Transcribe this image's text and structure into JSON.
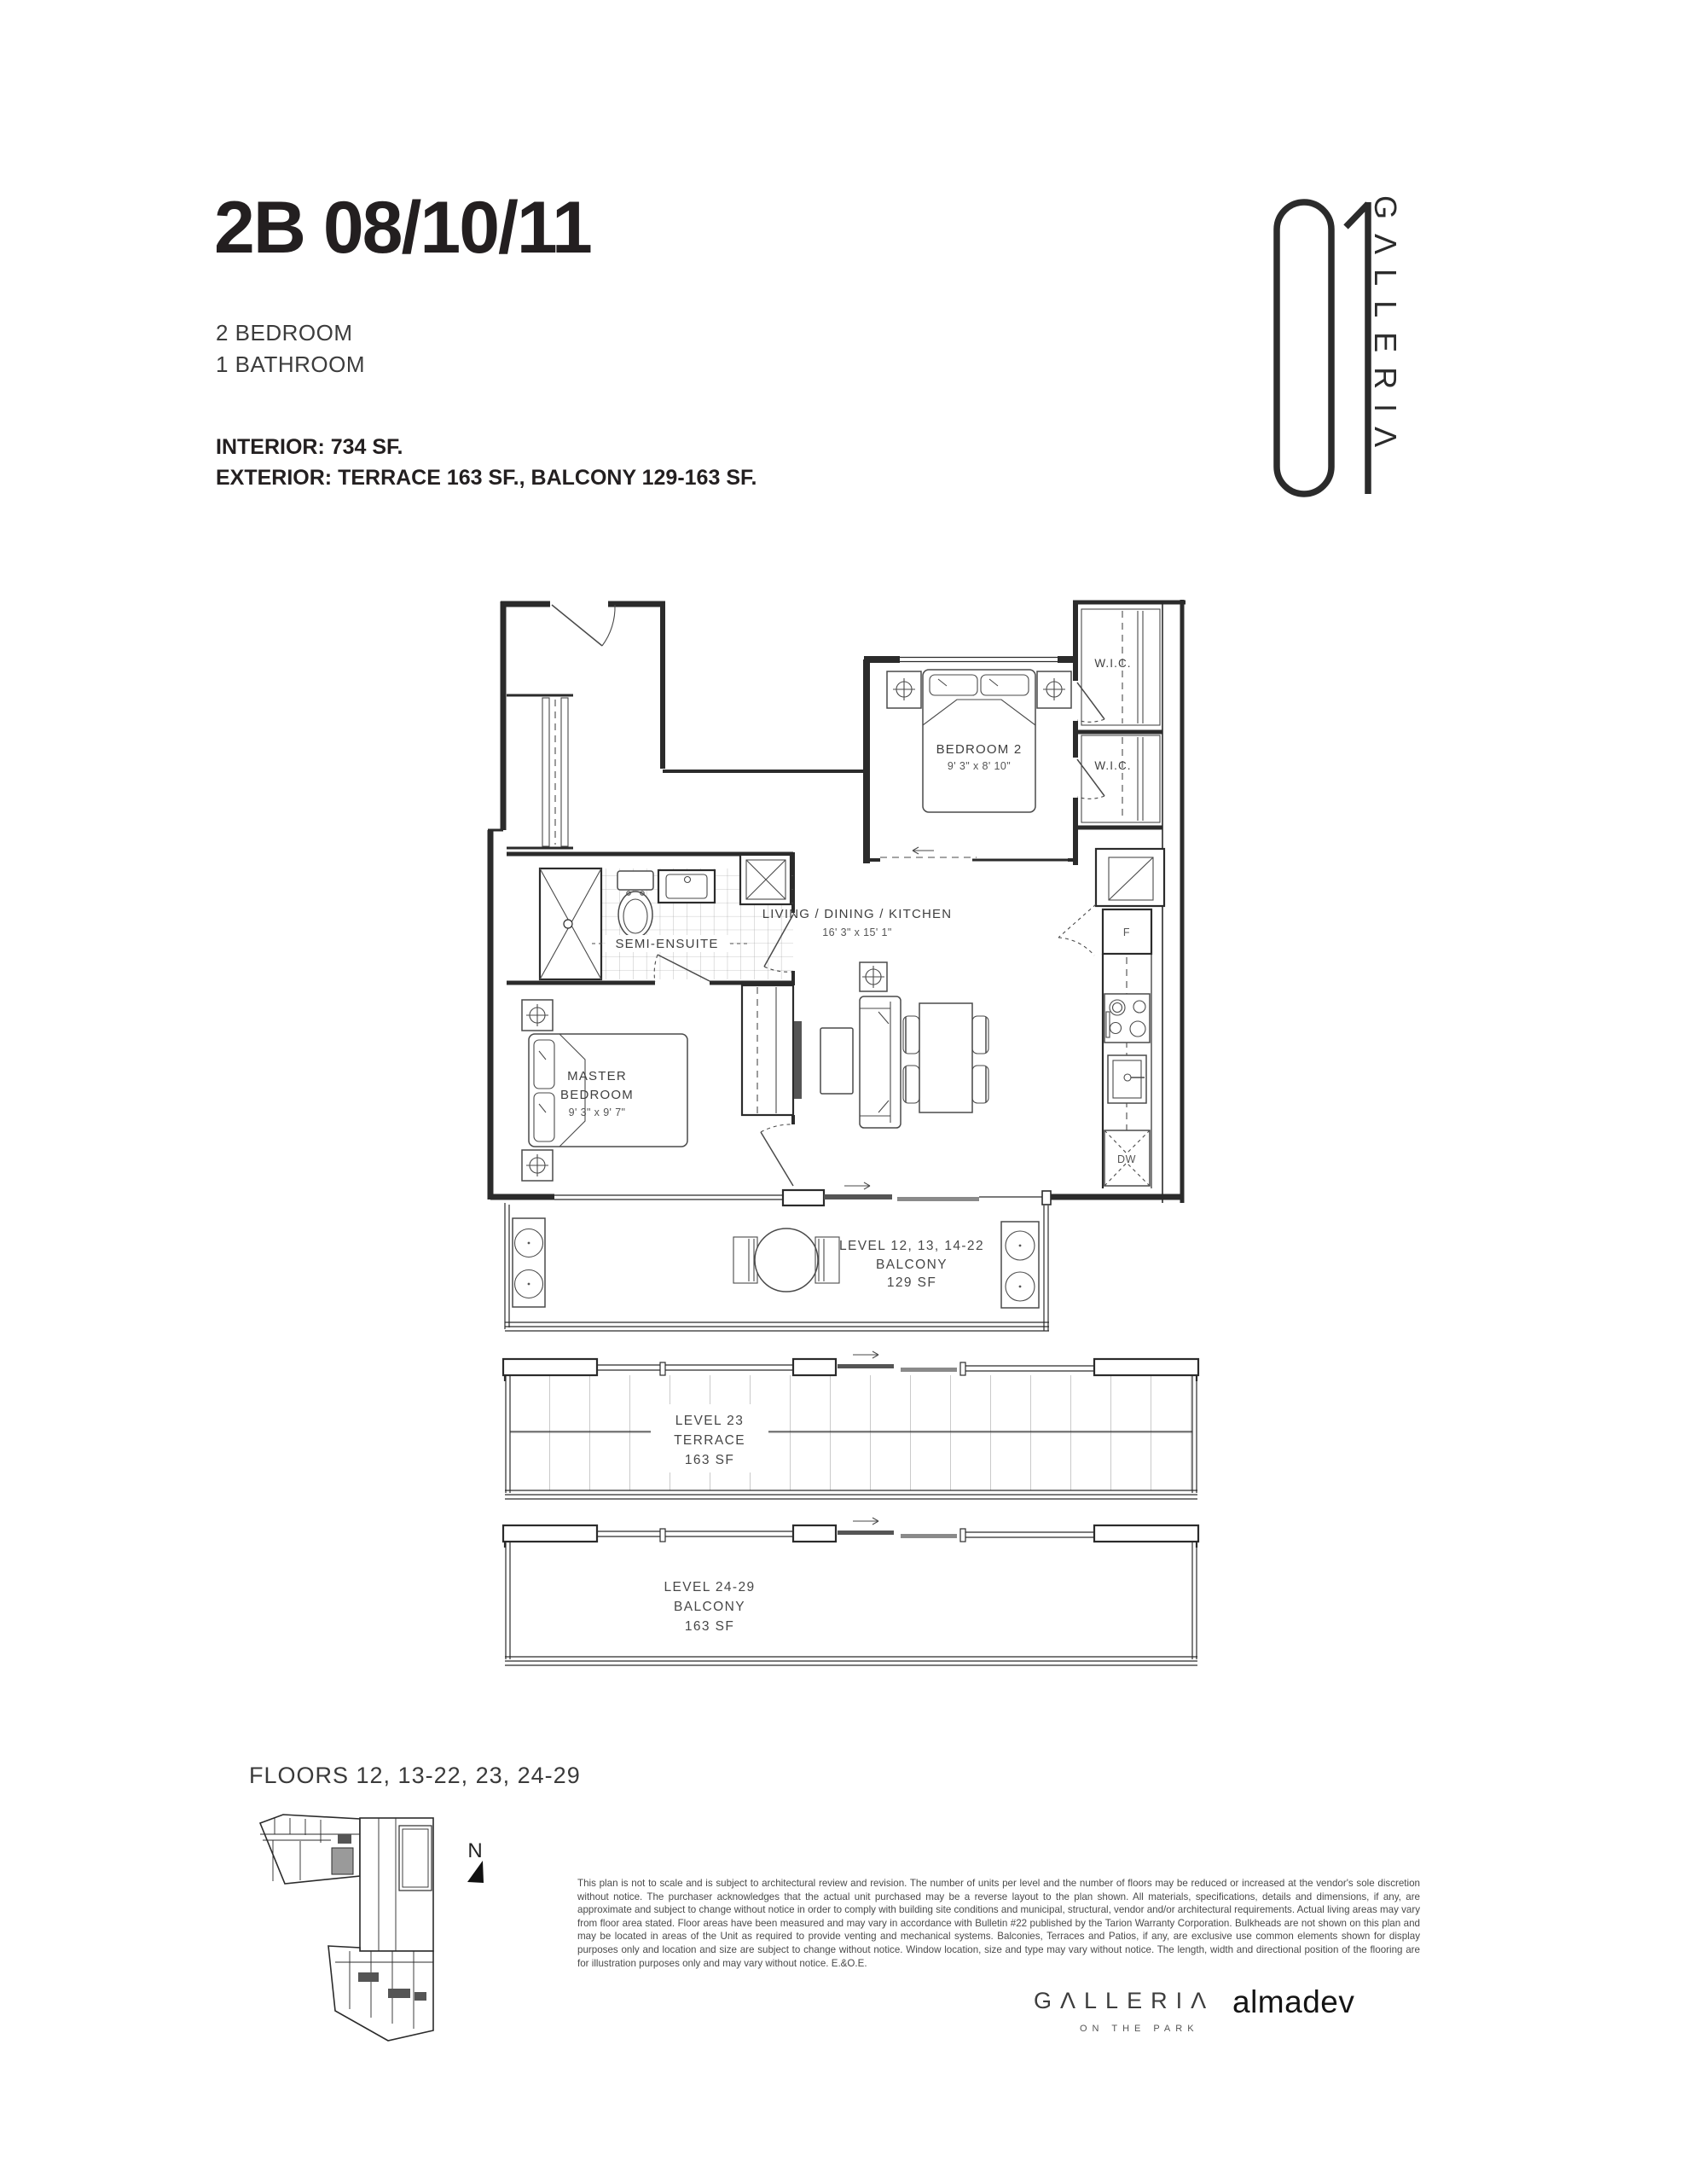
{
  "header": {
    "unit_code": "2B 08/10/11",
    "bedrooms": "2 BEDROOM",
    "bathrooms": "1 BATHROOM",
    "interior": "INTERIOR: 734 SF.",
    "exterior": "EXTERIOR: TERRACE 163 SF., BALCONY 129-163 SF."
  },
  "logo": {
    "number": "01",
    "name": "GΛLLERIΛ"
  },
  "plan": {
    "bedroom2": {
      "name": "BEDROOM 2",
      "dims": "9' 3\" x 8' 10\""
    },
    "master": {
      "line1": "MASTER",
      "line2": "BEDROOM",
      "dims": "9' 3\" x 9' 7\""
    },
    "living": {
      "name": "LIVING / DINING / KITCHEN",
      "dims": "16' 3\" x 15' 1\""
    },
    "semi_ensuite": "SEMI-ENSUITE",
    "wic_upper": "W.I.C.",
    "wic_lower": "W.I.C.",
    "fridge": "F",
    "dishwasher": "DW",
    "balcony_12": {
      "line1": "LEVEL 12, 13, 14-22",
      "line2": "BALCONY",
      "line3": "129 SF"
    },
    "terrace_23": {
      "line1": "LEVEL 23",
      "line2": "TERRACE",
      "line3": "163 SF"
    },
    "balcony_24": {
      "line1": "LEVEL 24-29",
      "line2": "BALCONY",
      "line3": "163 SF"
    }
  },
  "keyplan": {
    "floors_label": "FLOORS 12, 13-22, 23, 24-29",
    "north": "N"
  },
  "disclaimer": "This plan is not to scale and is subject to architectural review and revision. The number of units per level and the number of floors may be reduced or increased at the vendor's sole discretion without notice. The purchaser acknowledges that the actual unit purchased may be a reverse layout to the plan shown. All materials, specifications, details and dimensions, if any, are approximate and subject to change without notice in order to comply with building site conditions and municipal, structural, vendor and/or architectural requirements. Actual living areas may vary from floor area stated. Floor areas have been measured and may vary in accordance with Bulletin #22 published by the Tarion Warranty Corporation. Bulkheads are not shown on this plan and may be located in areas of the Unit as required to provide venting and mechanical systems. Balconies, Terraces and Patios, if any, are exclusive use common elements shown for display purposes only and location and size are subject to change without notice. Window location, size and type may vary without notice. The length, width and directional position of the flooring are for illustration purposes only and may vary without notice. E.&O.E.",
  "footer": {
    "brand": "GΛLLERIΛ",
    "tagline": "ON THE PARK",
    "developer": "almadev"
  }
}
